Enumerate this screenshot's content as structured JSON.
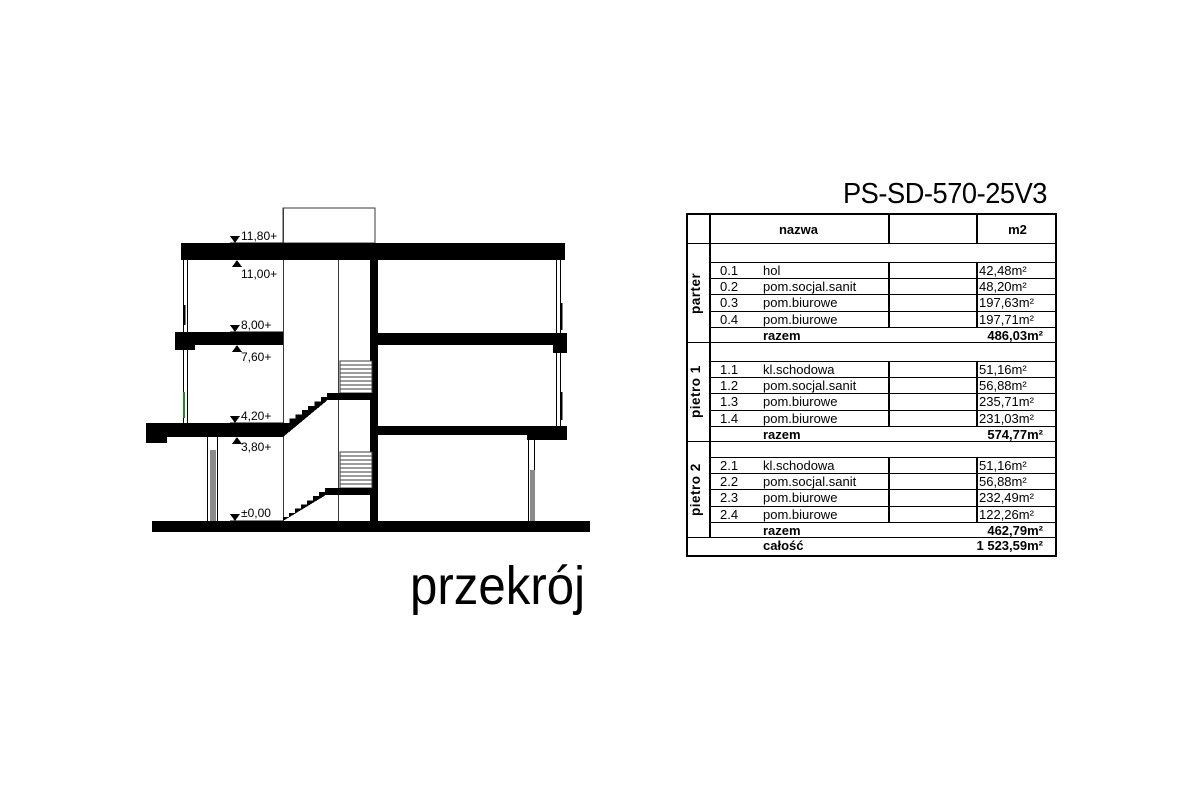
{
  "title": "PS-SD-570-25V3",
  "drawing": {
    "label": "przekrój",
    "elevations": {
      "e1180": "11,80+",
      "e1100": "11,00+",
      "e800": "8,00+",
      "e760": "7,60+",
      "e420": "4,20+",
      "e380": "3,80+",
      "e000": "±0,00"
    }
  },
  "table": {
    "header": {
      "nazwa": "nazwa",
      "m2": "m2"
    },
    "razem_label": "razem",
    "sections": [
      {
        "floor": "parter",
        "rows": [
          {
            "no": "0.1",
            "name": "hol",
            "area": "42,48m²"
          },
          {
            "no": "0.2",
            "name": "pom.socjal.sanit",
            "area": "48,20m²"
          },
          {
            "no": "0.3",
            "name": "pom.biurowe",
            "area": "197,63m²"
          },
          {
            "no": "0.4",
            "name": "pom.biurowe",
            "area": "197,71m²"
          }
        ],
        "razem": "486,03m²"
      },
      {
        "floor": "pietro 1",
        "rows": [
          {
            "no": "1.1",
            "name": "kl.schodowa",
            "area": "51,16m²"
          },
          {
            "no": "1.2",
            "name": "pom.socjal.sanit",
            "area": "56,88m²"
          },
          {
            "no": "1.3",
            "name": "pom.biurowe",
            "area": "235,71m²"
          },
          {
            "no": "1.4",
            "name": "pom.biurowe",
            "area": "231,03m²"
          }
        ],
        "razem": "574,77m²"
      },
      {
        "floor": "pietro 2",
        "rows": [
          {
            "no": "2.1",
            "name": "kl.schodowa",
            "area": "51,16m²"
          },
          {
            "no": "2.2",
            "name": "pom.socjal.sanit",
            "area": "56,88m²"
          },
          {
            "no": "2.3",
            "name": "pom.biurowe",
            "area": "232,49m²"
          },
          {
            "no": "2.4",
            "name": "pom.biurowe",
            "area": "122,26m²"
          }
        ],
        "razem": "462,79m²"
      }
    ],
    "total_label": "całość",
    "total": "1 523,59m²"
  },
  "colors": {
    "ink": "#000000",
    "glass_gray": "#8a8a8a",
    "window_green": "#1c8a1c"
  }
}
